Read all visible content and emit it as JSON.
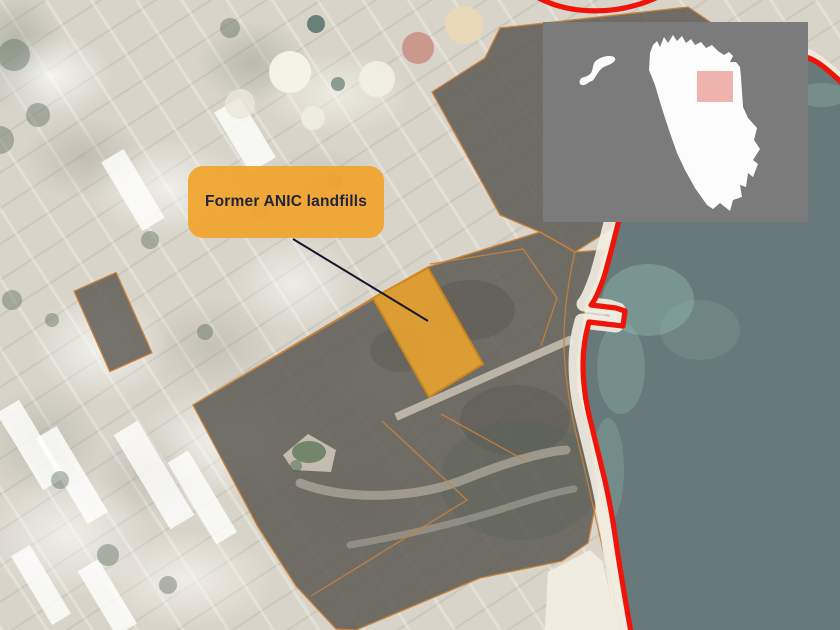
{
  "map": {
    "label": "Former ANIC landfills",
    "colors": {
      "coastline": "#EE1409",
      "sea": "#67797A",
      "shallow_water": "#8FB7AD",
      "sand_base": "#D8D4C9",
      "beach": "#F3EEE2",
      "dark_parcel": "#66645E",
      "parcel_outline": "#C9823A",
      "landfill_fill": "#EDA42F",
      "landfill_border": "#D88A14",
      "label_background": "#F0A52F",
      "label_text": "#23233D",
      "leader_line": "#17172E",
      "inset_background": "#7B7B7B",
      "inset_country": "#FCFCFC",
      "inset_marker": "#E0695B"
    }
  }
}
